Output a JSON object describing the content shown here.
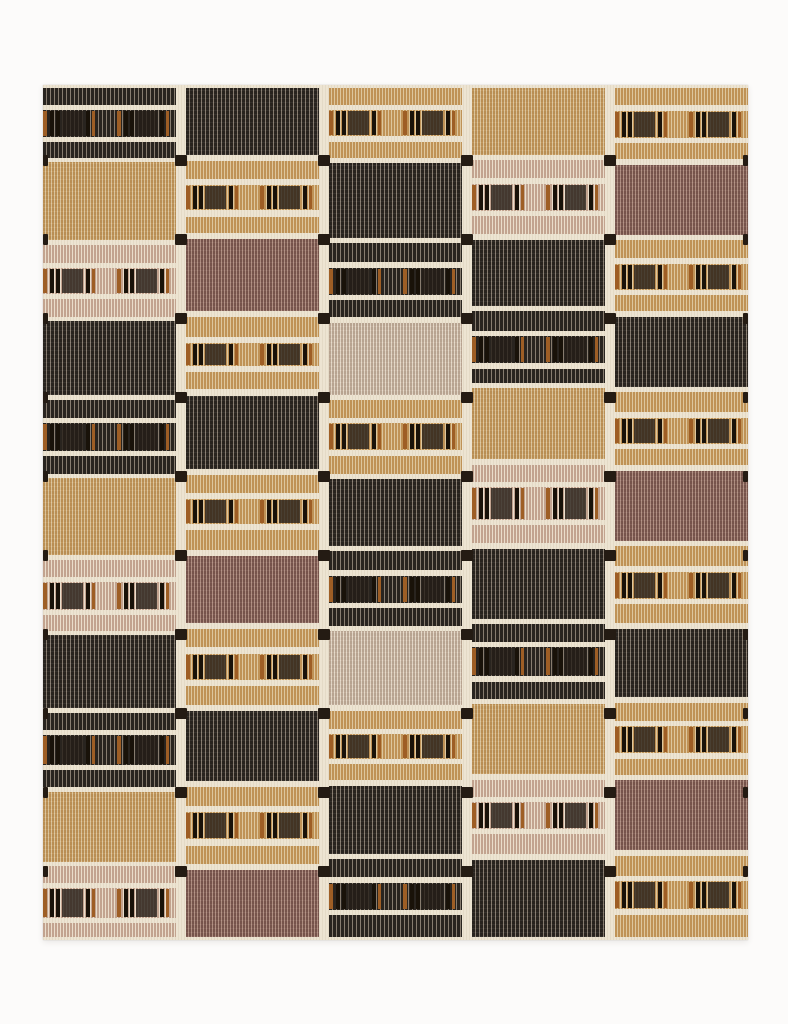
{
  "scene": {
    "background_color": "#fcfbfa",
    "subject": "Flat-woven wool kilim area rug, overhead product photo on white background",
    "style": "Geometric color-block grid of five vertical panels with cream stripe separators, small black junction squares, and pick-up dash motifs in black and rust"
  },
  "palette": {
    "cream": "#ede4d2",
    "camel": "#bf9256",
    "charcoal": "#29241f",
    "mauve": "#7a564d",
    "blush": "#c2a38f",
    "greige": "#bda895",
    "dash_black": "#191209",
    "dash_rust": "#9e5e25",
    "junction_square": "#241b13"
  },
  "rug": {
    "x": 43,
    "y": 85,
    "width": 705,
    "height": 855,
    "column_width": 133,
    "gutter": 10,
    "junction_squares": {
      "start": 70,
      "spacing": 79,
      "count": 10,
      "size": [
        12,
        11
      ],
      "edge_width": 5
    },
    "columns": [
      {
        "segments": [
          {
            "type": "band",
            "color": "charcoal",
            "h": 17
          },
          {
            "type": "dash",
            "color": "charcoal",
            "h": 27
          },
          {
            "type": "band",
            "color": "charcoal",
            "h": 16
          },
          {
            "type": "block",
            "color": "camel",
            "h": 78
          },
          {
            "type": "band",
            "color": "blush",
            "h": 18
          },
          {
            "type": "dash",
            "color": "blush",
            "h": 26
          },
          {
            "type": "band",
            "color": "blush",
            "h": 18
          },
          {
            "type": "block",
            "color": "charcoal",
            "h": 74
          },
          {
            "type": "band",
            "color": "charcoal",
            "h": 18
          },
          {
            "type": "dash",
            "color": "charcoal",
            "h": 28
          },
          {
            "type": "band",
            "color": "charcoal",
            "h": 18
          },
          {
            "type": "block",
            "color": "camel",
            "h": 77
          },
          {
            "type": "band",
            "color": "blush",
            "h": 17
          },
          {
            "type": "dash",
            "color": "blush",
            "h": 28
          },
          {
            "type": "band",
            "color": "blush",
            "h": 16
          },
          {
            "type": "block",
            "color": "charcoal",
            "h": 73
          },
          {
            "type": "band",
            "color": "charcoal",
            "h": 17
          },
          {
            "type": "dash",
            "color": "charcoal",
            "h": 30
          },
          {
            "type": "band",
            "color": "charcoal",
            "h": 17
          },
          {
            "type": "block",
            "color": "camel",
            "h": 70
          },
          {
            "type": "band",
            "color": "blush",
            "h": 17
          },
          {
            "type": "dash",
            "color": "blush",
            "h": 30
          },
          {
            "type": "band",
            "color": "blush",
            "h": 14
          }
        ]
      },
      {
        "segments": [
          {
            "type": "block",
            "color": "charcoal",
            "h": 67
          },
          {
            "type": "band",
            "color": "camel",
            "h": 18
          },
          {
            "type": "dash",
            "color": "camel",
            "h": 25
          },
          {
            "type": "band",
            "color": "camel",
            "h": 16
          },
          {
            "type": "block",
            "color": "mauve",
            "h": 72
          },
          {
            "type": "band",
            "color": "camel",
            "h": 20
          },
          {
            "type": "dash",
            "color": "camel",
            "h": 23
          },
          {
            "type": "band",
            "color": "camel",
            "h": 17
          },
          {
            "type": "block",
            "color": "charcoal",
            "h": 73
          },
          {
            "type": "band",
            "color": "camel",
            "h": 18
          },
          {
            "type": "dash",
            "color": "camel",
            "h": 25
          },
          {
            "type": "band",
            "color": "camel",
            "h": 20
          },
          {
            "type": "block",
            "color": "mauve",
            "h": 67
          },
          {
            "type": "band",
            "color": "camel",
            "h": 18
          },
          {
            "type": "dash",
            "color": "camel",
            "h": 26
          },
          {
            "type": "band",
            "color": "camel",
            "h": 19
          },
          {
            "type": "block",
            "color": "charcoal",
            "h": 70
          },
          {
            "type": "band",
            "color": "camel",
            "h": 19
          },
          {
            "type": "dash",
            "color": "camel",
            "h": 27
          },
          {
            "type": "band",
            "color": "camel",
            "h": 18
          },
          {
            "type": "block",
            "color": "mauve",
            "h": 67
          }
        ]
      },
      {
        "segments": [
          {
            "type": "band",
            "color": "camel",
            "h": 17
          },
          {
            "type": "dash",
            "color": "camel",
            "h": 26
          },
          {
            "type": "band",
            "color": "camel",
            "h": 16
          },
          {
            "type": "block",
            "color": "charcoal",
            "h": 75
          },
          {
            "type": "band",
            "color": "charcoal",
            "h": 19
          },
          {
            "type": "dash",
            "color": "charcoal",
            "h": 27
          },
          {
            "type": "band",
            "color": "charcoal",
            "h": 17
          },
          {
            "type": "block",
            "color": "greige",
            "h": 72
          },
          {
            "type": "band",
            "color": "camel",
            "h": 18
          },
          {
            "type": "dash",
            "color": "camel",
            "h": 27
          },
          {
            "type": "band",
            "color": "camel",
            "h": 18
          },
          {
            "type": "block",
            "color": "charcoal",
            "h": 67
          },
          {
            "type": "band",
            "color": "charcoal",
            "h": 19
          },
          {
            "type": "dash",
            "color": "charcoal",
            "h": 27
          },
          {
            "type": "band",
            "color": "charcoal",
            "h": 18
          },
          {
            "type": "block",
            "color": "greige",
            "h": 74
          },
          {
            "type": "band",
            "color": "camel",
            "h": 18
          },
          {
            "type": "dash",
            "color": "camel",
            "h": 25
          },
          {
            "type": "band",
            "color": "camel",
            "h": 16
          },
          {
            "type": "block",
            "color": "charcoal",
            "h": 68
          },
          {
            "type": "band",
            "color": "charcoal",
            "h": 18
          },
          {
            "type": "dash",
            "color": "charcoal",
            "h": 27
          },
          {
            "type": "band",
            "color": "charcoal",
            "h": 22
          }
        ]
      },
      {
        "segments": [
          {
            "type": "block",
            "color": "camel",
            "h": 67
          },
          {
            "type": "band",
            "color": "blush",
            "h": 18
          },
          {
            "type": "dash",
            "color": "blush",
            "h": 27
          },
          {
            "type": "band",
            "color": "blush",
            "h": 18
          },
          {
            "type": "block",
            "color": "charcoal",
            "h": 66
          },
          {
            "type": "band",
            "color": "charcoal",
            "h": 20
          },
          {
            "type": "dash",
            "color": "charcoal",
            "h": 27
          },
          {
            "type": "band",
            "color": "charcoal",
            "h": 14
          },
          {
            "type": "block",
            "color": "camel",
            "h": 71
          },
          {
            "type": "band",
            "color": "blush",
            "h": 17
          },
          {
            "type": "dash",
            "color": "blush",
            "h": 33
          },
          {
            "type": "band",
            "color": "blush",
            "h": 18
          },
          {
            "type": "block",
            "color": "charcoal",
            "h": 70
          },
          {
            "type": "band",
            "color": "charcoal",
            "h": 18
          },
          {
            "type": "dash",
            "color": "charcoal",
            "h": 29
          },
          {
            "type": "band",
            "color": "charcoal",
            "h": 17
          },
          {
            "type": "block",
            "color": "camel",
            "h": 70
          },
          {
            "type": "band",
            "color": "blush",
            "h": 17
          },
          {
            "type": "dash",
            "color": "blush",
            "h": 27
          },
          {
            "type": "band",
            "color": "blush",
            "h": 20
          },
          {
            "type": "block",
            "color": "charcoal",
            "h": 77
          }
        ]
      },
      {
        "segments": [
          {
            "type": "band",
            "color": "camel",
            "h": 17
          },
          {
            "type": "dash",
            "color": "camel",
            "h": 27
          },
          {
            "type": "band",
            "color": "camel",
            "h": 16
          },
          {
            "type": "block",
            "color": "mauve",
            "h": 70
          },
          {
            "type": "band",
            "color": "camel",
            "h": 18
          },
          {
            "type": "dash",
            "color": "camel",
            "h": 26
          },
          {
            "type": "band",
            "color": "camel",
            "h": 16
          },
          {
            "type": "block",
            "color": "charcoal",
            "h": 70
          },
          {
            "type": "band",
            "color": "camel",
            "h": 20
          },
          {
            "type": "dash",
            "color": "camel",
            "h": 26
          },
          {
            "type": "band",
            "color": "camel",
            "h": 16
          },
          {
            "type": "block",
            "color": "mauve",
            "h": 70
          },
          {
            "type": "band",
            "color": "camel",
            "h": 20
          },
          {
            "type": "dash",
            "color": "camel",
            "h": 27
          },
          {
            "type": "band",
            "color": "camel",
            "h": 19
          },
          {
            "type": "block",
            "color": "charcoal",
            "h": 68
          },
          {
            "type": "band",
            "color": "camel",
            "h": 18
          },
          {
            "type": "dash",
            "color": "camel",
            "h": 27
          },
          {
            "type": "band",
            "color": "camel",
            "h": 16
          },
          {
            "type": "block",
            "color": "mauve",
            "h": 70
          },
          {
            "type": "band",
            "color": "camel",
            "h": 20
          },
          {
            "type": "dash",
            "color": "camel",
            "h": 28
          },
          {
            "type": "band",
            "color": "camel",
            "h": 22
          }
        ]
      }
    ]
  }
}
